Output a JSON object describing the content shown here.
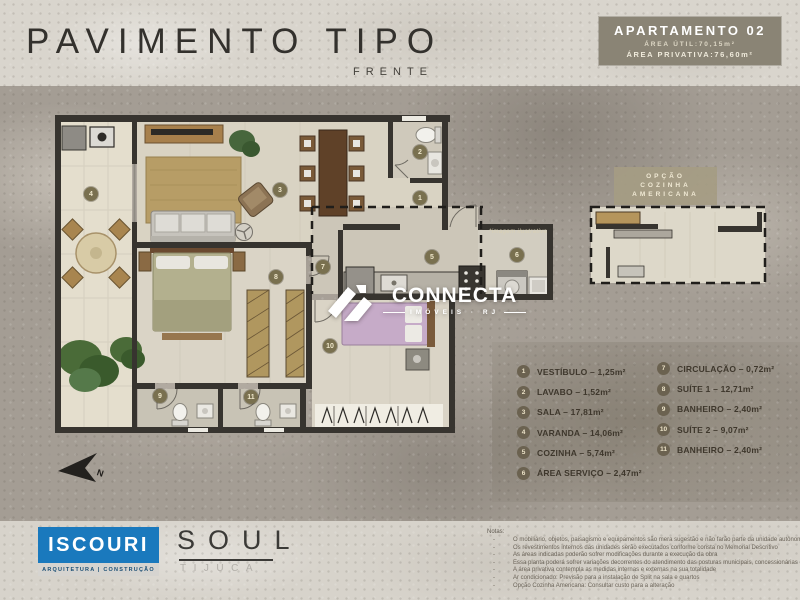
{
  "title": "PAVIMENTO TIPO",
  "subtitle": "FRENTE",
  "badge": {
    "name": "APARTAMENTO 02",
    "area_util": "ÁREA ÚTIL:70,15m²",
    "area_privativa": "ÁREA PRIVATIVA:76,60m²"
  },
  "option": {
    "line1": "OPÇÃO",
    "line2": "COZINHA",
    "line3": "AMERICANA"
  },
  "plan": {
    "illustrative_note": "*imagem ilustrativa",
    "compass": "N"
  },
  "legend": {
    "items": [
      {
        "num": "1",
        "label": "VESTÍBULO – 1,25m²"
      },
      {
        "num": "2",
        "label": "LAVABO – 1,52m²"
      },
      {
        "num": "3",
        "label": "SALA – 17,81m²"
      },
      {
        "num": "4",
        "label": "VARANDA – 14,06m²"
      },
      {
        "num": "5",
        "label": "COZINHA – 5,74m²"
      },
      {
        "num": "6",
        "label": "ÁREA SERVIÇO – 2,47m²"
      },
      {
        "num": "7",
        "label": "CIRCULAÇÃO – 0,72m²"
      },
      {
        "num": "8",
        "label": "SUÍTE 1 – 12,71m²"
      },
      {
        "num": "9",
        "label": "BANHEIRO – 2,40m²"
      },
      {
        "num": "10",
        "label": "SUÍTE 2 – 9,07m²"
      },
      {
        "num": "11",
        "label": "BANHEIRO – 2,40m²"
      }
    ]
  },
  "watermark": {
    "name": "CONNECTA",
    "tagline": "IMÓVEIS · RJ"
  },
  "logos": {
    "iscouri": {
      "name": "ISCOURI",
      "tagline": "ARQUITETURA | CONSTRUÇÃO"
    },
    "soul": {
      "name": "SOUL",
      "tagline": "TIJUCA"
    }
  },
  "notes": {
    "title": "Notas:",
    "lines": [
      "O mobiliário, objetos, paisagismo e equipamentos são mera sugestão e não farão parte da unidade autônoma",
      "Os revestimentos internos das unidades serão executados conforme consta no Memorial Descritivo",
      "As áreas indicadas poderão sofrer modificações durante a execução da obra",
      "Essa planta poderá sofrer variações decorrentes do atendimento das posturas municipais, concessionárias e do local",
      "A área privativa contempla as medidas internas e externas na sua totalidade",
      "Ar condicionado: Previsão para a instalação de Split na sala e quartos",
      "Opção Cozinha Americana: Consultar custo para a alteração"
    ]
  },
  "colors": {
    "accent_blue": "#1a79bd",
    "badge_olive": "#8a8475",
    "wall": "#37342f",
    "marker_olive": "#79704f"
  }
}
